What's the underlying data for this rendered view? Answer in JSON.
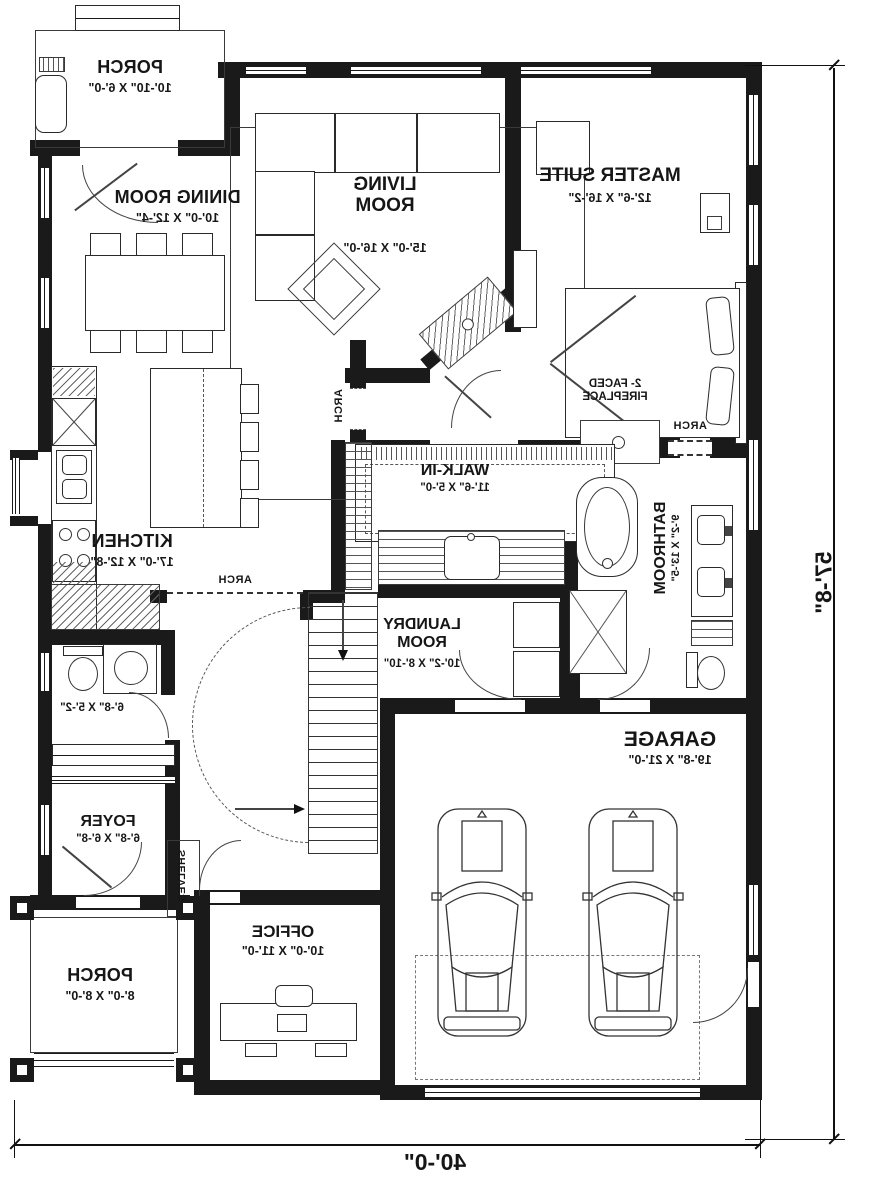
{
  "rooms": {
    "porch_top": {
      "name": "PORCH",
      "dims": "10'-10\" X 6'-0\""
    },
    "dining": {
      "name": "DINING ROOM",
      "dims": "10'-0\" X 12'-4\""
    },
    "living": {
      "name": "LIVING ROOM",
      "dims": "15'-0\" X 16'-0\""
    },
    "master": {
      "name": "MASTER SUITE",
      "dims": "12'-6\" X 16'-2\""
    },
    "kitchen": {
      "name": "KITCHEN",
      "dims": "17'-0\" X 12'-8\""
    },
    "walkin": {
      "name": "WALK-IN",
      "dims": "11'-6\" X 5'-0\""
    },
    "bathroom": {
      "name": "BATHROOM",
      "dims": "9'-2\" X 13'-5\""
    },
    "laundry": {
      "name": "LAUNDRY ROOM",
      "dims": "10'-2\" X 8'-10\""
    },
    "powder": {
      "dims": "6'-8\" X 5'-2\""
    },
    "foyer": {
      "name": "FOYER",
      "dims": "6'-8\" X 6'-8\""
    },
    "office": {
      "name": "OFFICE",
      "dims": "10'-0\" X 11'-0\""
    },
    "porch_bottom": {
      "name": "PORCH",
      "dims": "8'-0\" X 8'-0\""
    },
    "garage": {
      "name": "GARAGE",
      "dims": "19'-8\" X 21'-0\""
    }
  },
  "annotations": {
    "fireplace": "2- FACED FIREPLACE",
    "arch": "ARCH",
    "shelves": "SHELVES"
  },
  "overall_dimensions": {
    "width": "40'-0\"",
    "depth": "57'-8\""
  },
  "colors": {
    "wall": "#1a1a1a",
    "line": "#333333",
    "background": "#ffffff"
  }
}
